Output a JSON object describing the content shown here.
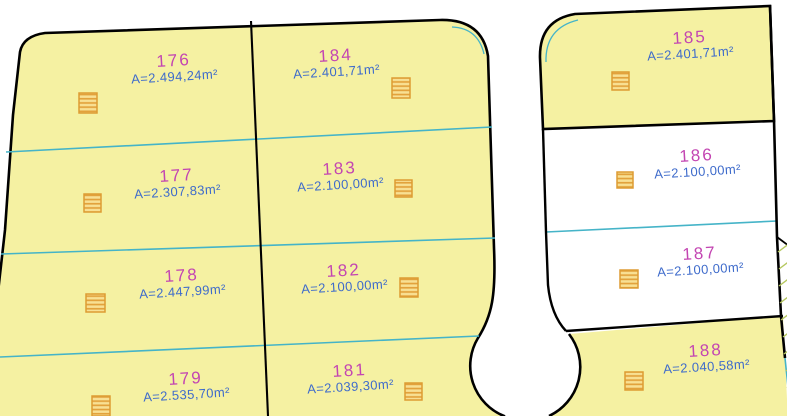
{
  "drawing_title": "Cadastral parcel plan",
  "colors": {
    "parcel_fill_yellow": "#f5f1a2",
    "parcel_fill_white": "#ffffff",
    "boundary_black": "#000000",
    "divider_cyan": "#45b4c8",
    "parcel_number_magenta": "#c345b2",
    "area_text_blue": "#3e6bcb",
    "marker_orange": "#e2a23c",
    "slope_hatch_green": "#b5c75f"
  },
  "symbols": {
    "hatch_square": "hatched-area-marker",
    "slope_ticks": "slope-hatch-marks"
  },
  "parcels": [
    {
      "number": "176",
      "area": "A=2.494,24m²",
      "fill": "yellow"
    },
    {
      "number": "177",
      "area": "A=2.307,83m²",
      "fill": "yellow"
    },
    {
      "number": "178",
      "area": "A=2.447,99m²",
      "fill": "yellow"
    },
    {
      "number": "179",
      "area": "A=2.535,70m²",
      "fill": "yellow"
    },
    {
      "number": "184",
      "area": "A=2.401,71m²",
      "fill": "yellow"
    },
    {
      "number": "183",
      "area": "A=2.100,00m²",
      "fill": "yellow"
    },
    {
      "number": "182",
      "area": "A=2.100,00m²",
      "fill": "yellow"
    },
    {
      "number": "181",
      "area": "A=2.039,30m²",
      "fill": "yellow"
    },
    {
      "number": "185",
      "area": "A=2.401,71m²",
      "fill": "yellow"
    },
    {
      "number": "186",
      "area": "A=2.100,00m²",
      "fill": "white"
    },
    {
      "number": "187",
      "area": "A=2.100,00m²",
      "fill": "white"
    },
    {
      "number": "188",
      "area": "A=2.040,58m²",
      "fill": "yellow"
    }
  ]
}
